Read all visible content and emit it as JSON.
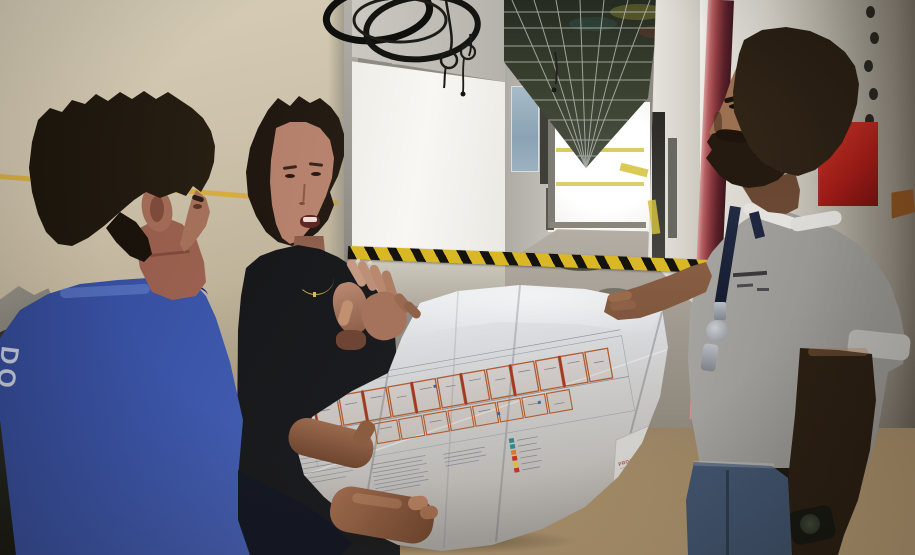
{
  "blueprint": {
    "title_block_text": "PROJETO ARQUITETÔNICO"
  },
  "blue_shirt": {
    "back_text": "DO"
  },
  "palette": {
    "beige_wall": "#cdc2ac",
    "caution_yellow": "#d9b725",
    "blue_shirt": "#3b55a8",
    "black_shirt": "#17181a",
    "white_shirt": "#cfcdc9",
    "extinguisher_red": "#a81c1c",
    "pipe_maroon": "#8c3a40",
    "plan_wall_orange": "#b05c30",
    "paper": "#d5d5d7"
  }
}
